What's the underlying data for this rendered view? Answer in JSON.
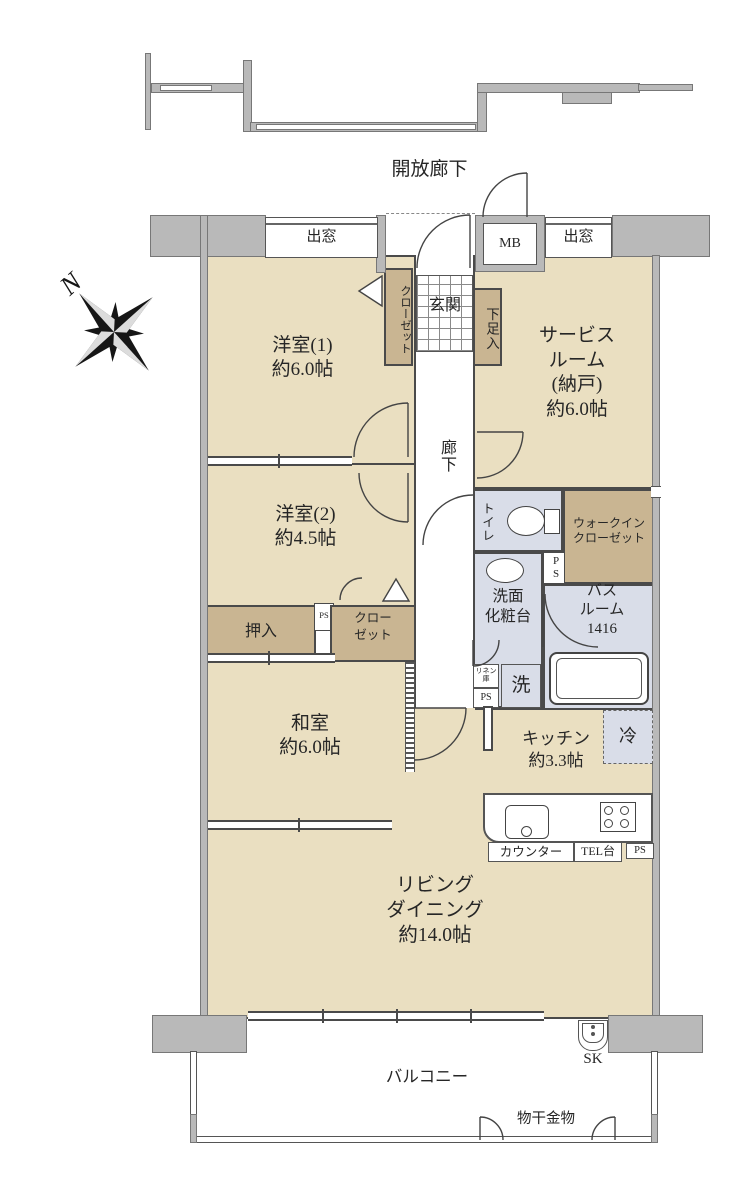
{
  "colors": {
    "floor": "#eadfc1",
    "closet": "#c9b592",
    "wet": "#d9dde8",
    "wall_gray": "#b9b9b9",
    "line": "#4a4a4a"
  },
  "compass": {
    "north": "N"
  },
  "common": {
    "open_corridor": "開放廊下",
    "bay_window": "出窓",
    "meter_box": "MB",
    "ps": "PS",
    "sk": "SK"
  },
  "entrance": {
    "genkan": "玄関",
    "shoe_cabinet": "下足入",
    "closet": "クローゼット",
    "hallway": "廊下"
  },
  "rooms": {
    "western1": "洋室(1)\n約6.0帖",
    "western2": "洋室(2)\n約4.5帖",
    "service_room": "サービス\nルーム\n(納戸)\n約6.0帖",
    "japanese": "和室\n約6.0帖",
    "kitchen": "キッチン\n約3.3帖",
    "living": "リビング\nダイニング\n約14.0帖"
  },
  "storage": {
    "oshiire": "押入",
    "closet2": "クロー\nゼット",
    "wic": "ウォークイン\nクローゼット",
    "linen": "リネン\n庫"
  },
  "wet_areas": {
    "toilet": "トイレ",
    "vanity": "洗面\n化粧台",
    "bath": "バス\nルーム\n1416",
    "laundry": "洗",
    "fridge": "冷"
  },
  "kitchen_fixtures": {
    "counter": "カウンター",
    "tel_stand": "TEL台"
  },
  "balcony": {
    "label": "バルコニー",
    "laundry_hardware": "物干金物"
  }
}
